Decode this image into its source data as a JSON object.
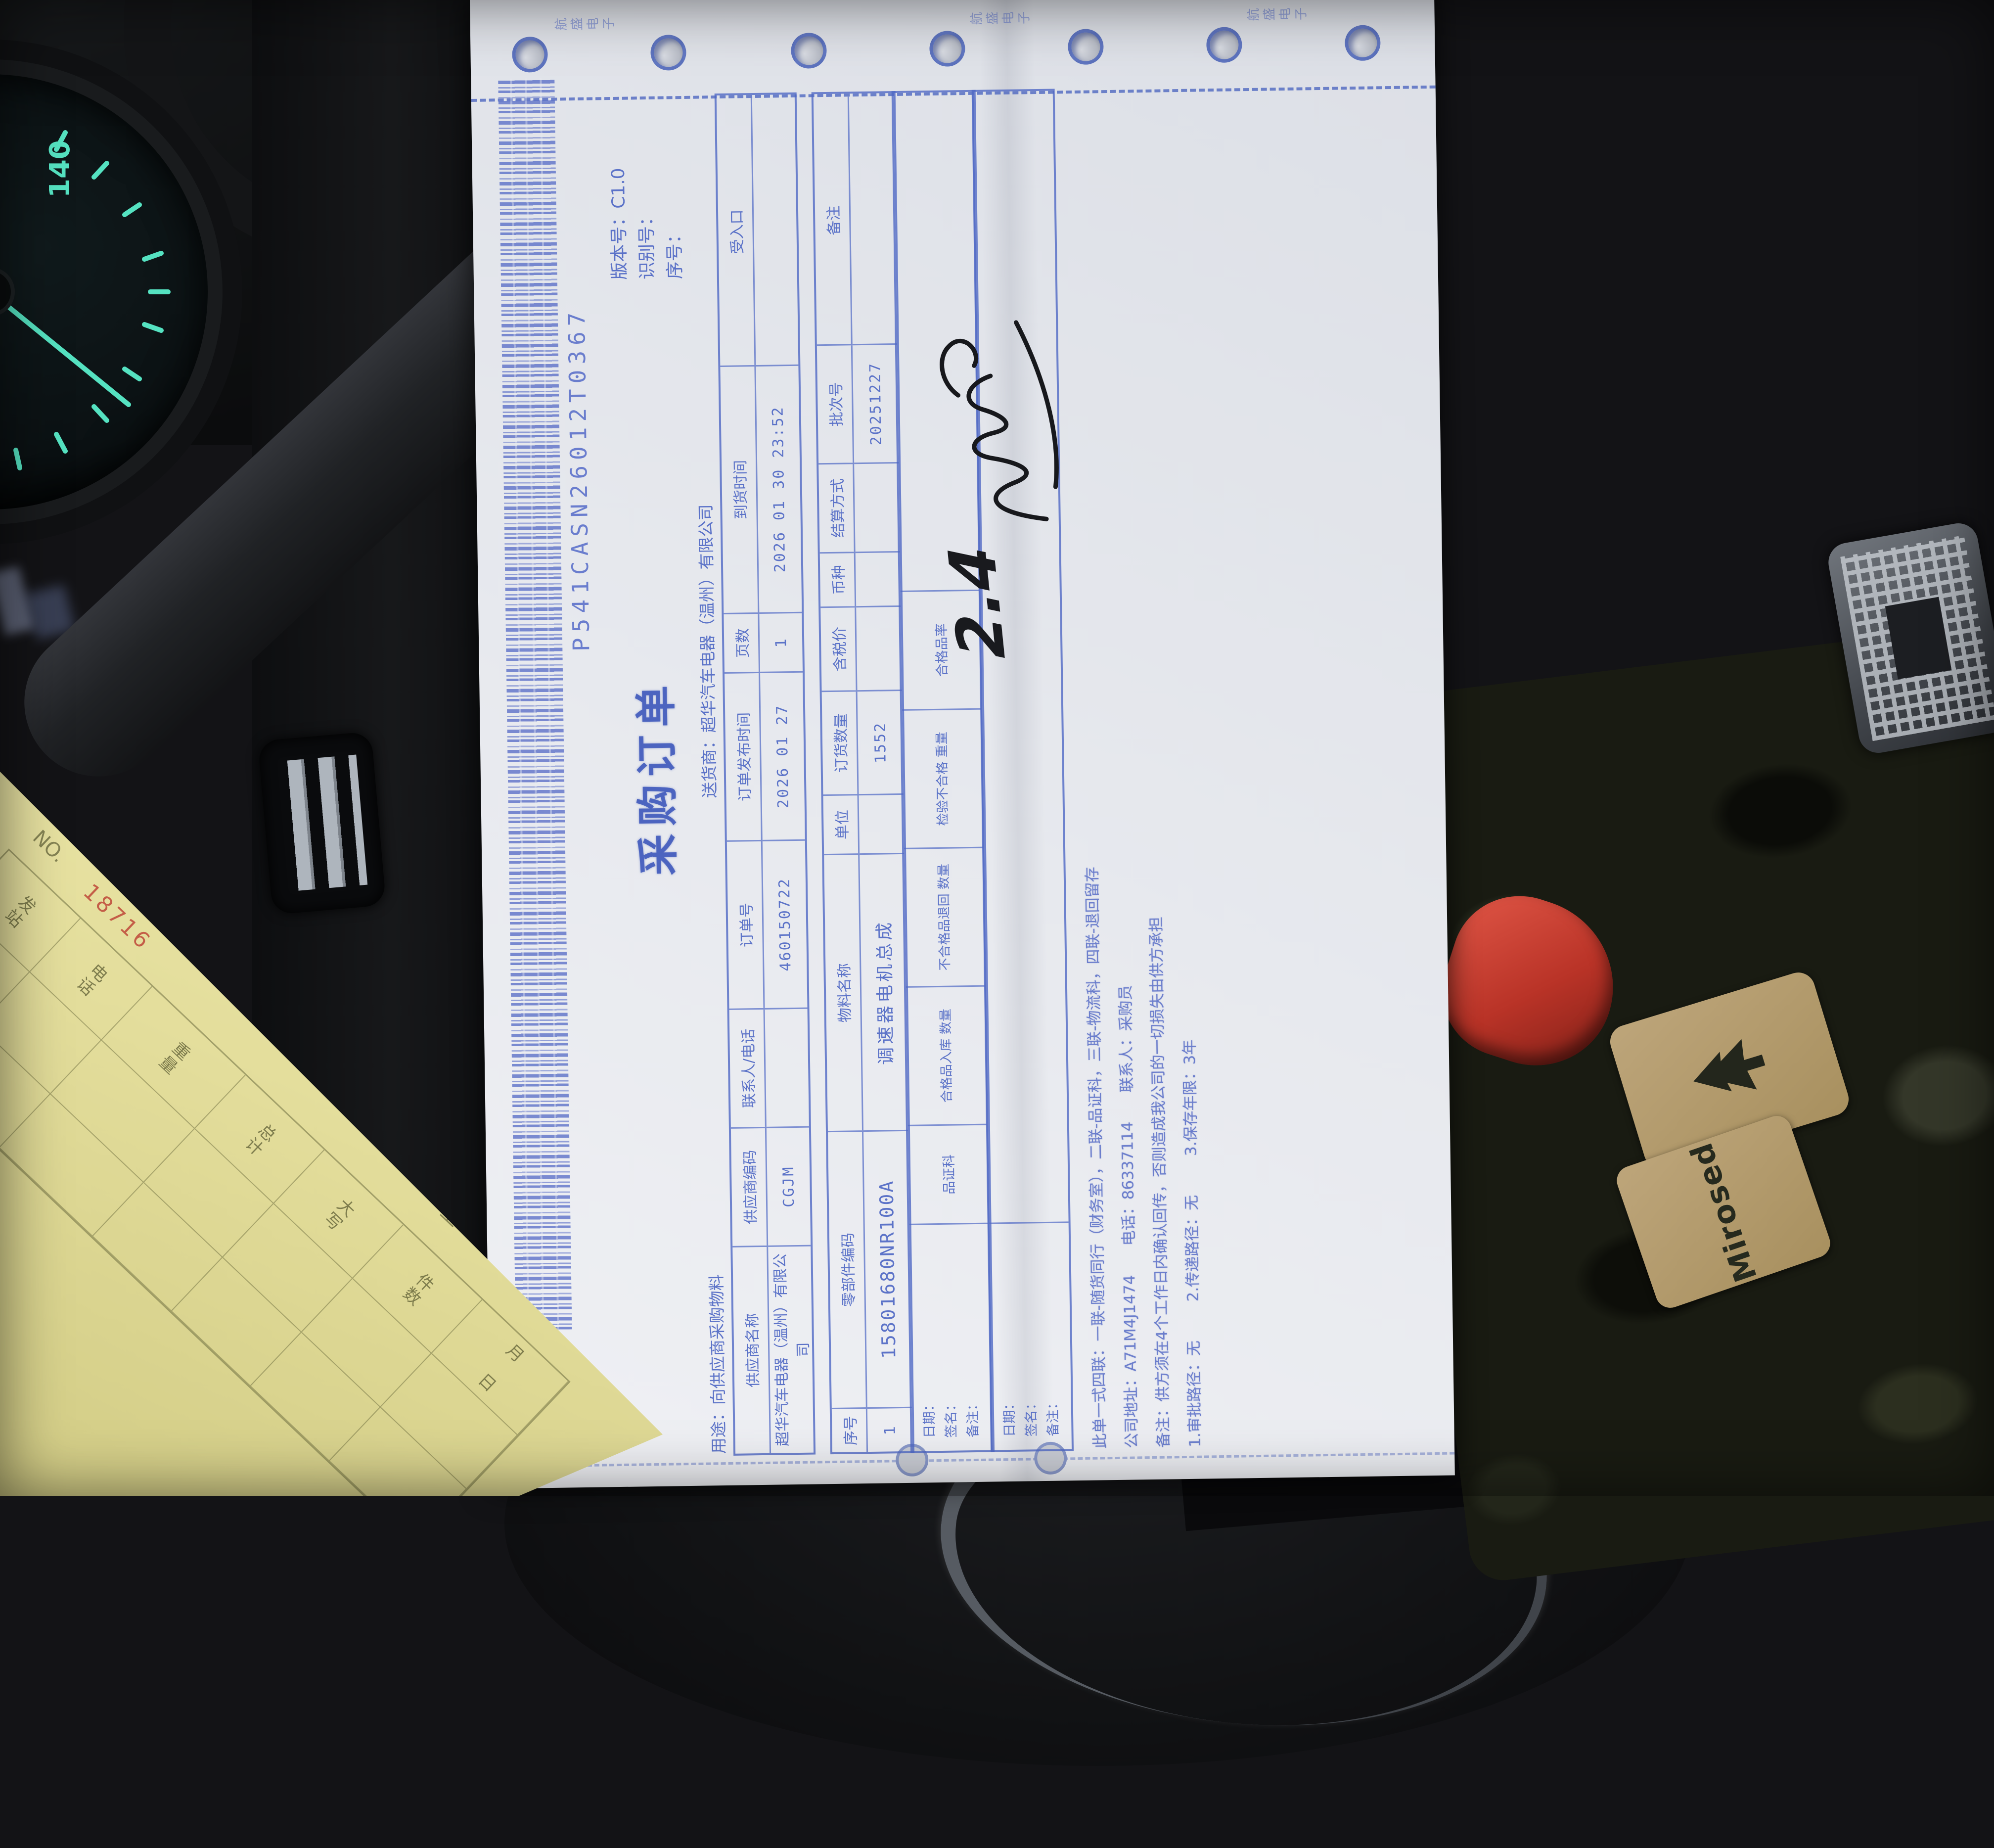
{
  "document": {
    "edge_strip": {
      "group_text": "航盛电子"
    },
    "barcode_text": "P541CASN26012T0367",
    "meta": {
      "version_line": "版本号：C1.0",
      "id_line": "识别号：",
      "seq_line": "序号："
    },
    "title": "采购订单",
    "usage_line": "用途：向供应商采购物料",
    "consignee_line": "送货商：超华汽车电器（温州）有限公司",
    "info_table": {
      "headers": [
        "供应商名称",
        "供应商编码",
        "联系人/电话",
        "订单号",
        "订单发布时间",
        "页数",
        "到货时间",
        "受入口"
      ],
      "values": [
        "超华汽车电器（温州）有限公司",
        "CGJM",
        "",
        "460150722",
        "2026 01 27",
        "1",
        "2026 01 30 23:52",
        ""
      ]
    },
    "item_table": {
      "headers": [
        "序号",
        "零部件编码",
        "物料名称",
        "单位",
        "订货数量",
        "含税价",
        "币种",
        "结算方式",
        "批次号",
        "备注"
      ],
      "row": [
        "1",
        "15801680NR100A",
        "调速器电机总成",
        "",
        "1552",
        "",
        "",
        "",
        "20251227",
        ""
      ]
    },
    "inspection": {
      "dept": "品证科",
      "rate_label": "合格品率",
      "check_headers": [
        "合格品入库 数量",
        "不合格品退回 数量",
        "检验不合格 重量"
      ],
      "sign_labels": [
        "日期：",
        "签名：",
        "备注："
      ]
    },
    "handwriting": {
      "note": "2.4"
    },
    "footer_lines": [
      "此单一式四联：一联-随货同行（财务室），二联-品证科，三联-物流科，四联-退回留存",
      "公司地址：A71M4J1474      电话：86337114      联系人：采购员",
      "备注：供方须在4个工作日内确认回传，否则造成我公司的一切损失由供方承担",
      "1.审批路径：无        2.传递路径：无        3.保存年限：3年"
    ]
  },
  "yellow_form": {
    "title_visible": "单运托物货司公运货",
    "no_label": "NO.",
    "no_value": "18716",
    "type_label": "普通",
    "route_label": "至",
    "headers": [
      "发站",
      "电话",
      "重量",
      "总计",
      "大写",
      "件数",
      "月 日"
    ]
  },
  "scene": {
    "gauge_label": "140",
    "patch_text": "Mirosed"
  }
}
